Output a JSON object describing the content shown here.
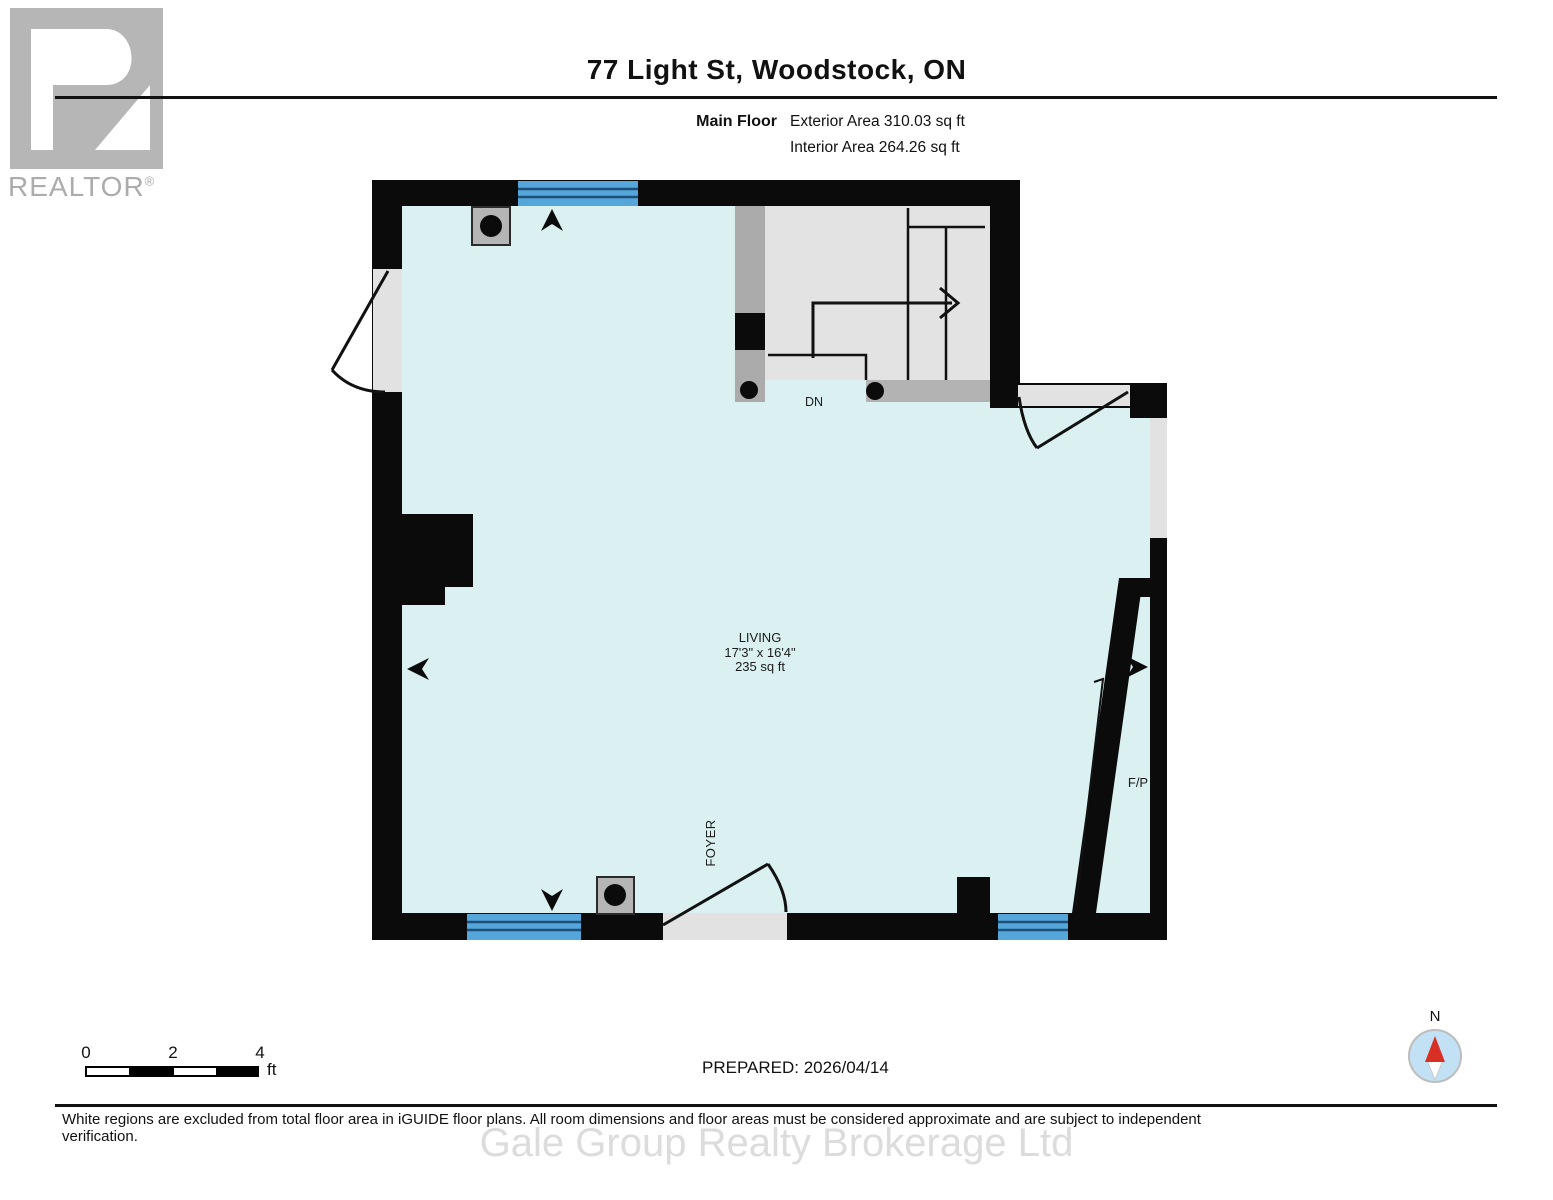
{
  "header": {
    "logo": {
      "brand": "REALTOR",
      "registered": "®"
    },
    "title": "77 Light St, Woodstock, ON",
    "floor_label": "Main Floor",
    "exterior_area": "Exterior Area 310.03 sq ft",
    "interior_area": "Interior Area 264.26 sq ft"
  },
  "plan": {
    "room": {
      "name": "LIVING",
      "dimensions": "17'3\" x 16'4\"",
      "area": "235 sq ft"
    },
    "labels": {
      "stairs_down": "DN",
      "foyer": "FOYER",
      "fireplace": "F/P"
    },
    "colors": {
      "floor": "#DAF0F1",
      "wall": "#0B0B0B",
      "window_blue": "#55A7DB",
      "window_stripe": "#1D4F79",
      "stair_floor": "#E3E3E3",
      "opening_gray": "#E2E2E2",
      "mid_gray": "#ABABAB",
      "landing_gray": "#B3B3B3",
      "compass_red": "#D93025"
    }
  },
  "footer": {
    "scale": {
      "t0": "0",
      "t2": "2",
      "t4": "4",
      "unit": "ft"
    },
    "prepared": "PREPARED: 2026/04/14",
    "compass_north": "N",
    "disclaimer": "White regions are excluded from total floor area in iGUIDE floor plans. All room dimensions and floor areas must be considered approximate and are subject to independent verification.",
    "watermark": "Gale Group Realty Brokerage Ltd"
  }
}
